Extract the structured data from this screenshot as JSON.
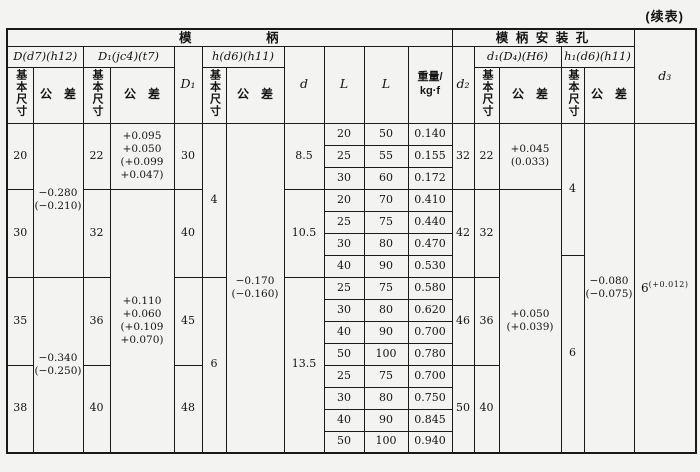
{
  "note": "(续表)",
  "header": {
    "groups": {
      "die_shank": "模　　　　　柄",
      "mounting_hole": "模 柄 安 装 孔"
    },
    "fits": {
      "D": "D(d7)(h12)",
      "D1": "D₁(jc4)(t7)",
      "h": "h(d6)(h11)",
      "d1": "d₁(D₄)(H6)",
      "h1": "h₁(d6)(h11)"
    },
    "cols": {
      "D1": "D₁",
      "d": "d",
      "L1": "L",
      "L2": "L",
      "weight": "重量/\nkg·f",
      "d2": "d₂",
      "d3": "d₃"
    },
    "sub": {
      "basic": "基本尺寸",
      "tol": "公　差"
    }
  },
  "body": {
    "D": [
      "20",
      "30",
      "35",
      "38"
    ],
    "D_tol": [
      "−0.280\n(−0.210)",
      "−0.340\n(−0.250)"
    ],
    "D1": [
      "22",
      "32",
      "36",
      "40"
    ],
    "D1_tol": [
      "+0.095\n+0.050\n(+0.099\n+0.047)",
      "+0.110\n+0.060\n(+0.109\n+0.070)"
    ],
    "D1b": [
      "30",
      "40",
      "45",
      "48"
    ],
    "h": [
      "4",
      "6"
    ],
    "h_tol": "−0.170\n(−0.160)",
    "d": [
      "8.5",
      "10.5",
      "13.5"
    ],
    "L1": [
      "20",
      "25",
      "30",
      "20",
      "25",
      "30",
      "40",
      "25",
      "30",
      "40",
      "50",
      "25",
      "30",
      "40",
      "50"
    ],
    "L2": [
      "50",
      "55",
      "60",
      "70",
      "75",
      "80",
      "90",
      "75",
      "80",
      "90",
      "100",
      "75",
      "80",
      "90",
      "100"
    ],
    "weight": [
      "0.140",
      "0.155",
      "0.172",
      "0.410",
      "0.440",
      "0.470",
      "0.530",
      "0.580",
      "0.620",
      "0.700",
      "0.780",
      "0.700",
      "0.750",
      "0.845",
      "0.940"
    ],
    "d2": [
      "32",
      "42",
      "46",
      "50"
    ],
    "d1": [
      "22",
      "32",
      "36",
      "40"
    ],
    "d1_tol": [
      "+0.045\n(0.033)",
      "+0.050\n(+0.039)"
    ],
    "h1": [
      "4",
      "6"
    ],
    "h1_tol": "−0.080\n(−0.075)",
    "d3_base": "6",
    "d3_sup": "(+0.012)"
  }
}
